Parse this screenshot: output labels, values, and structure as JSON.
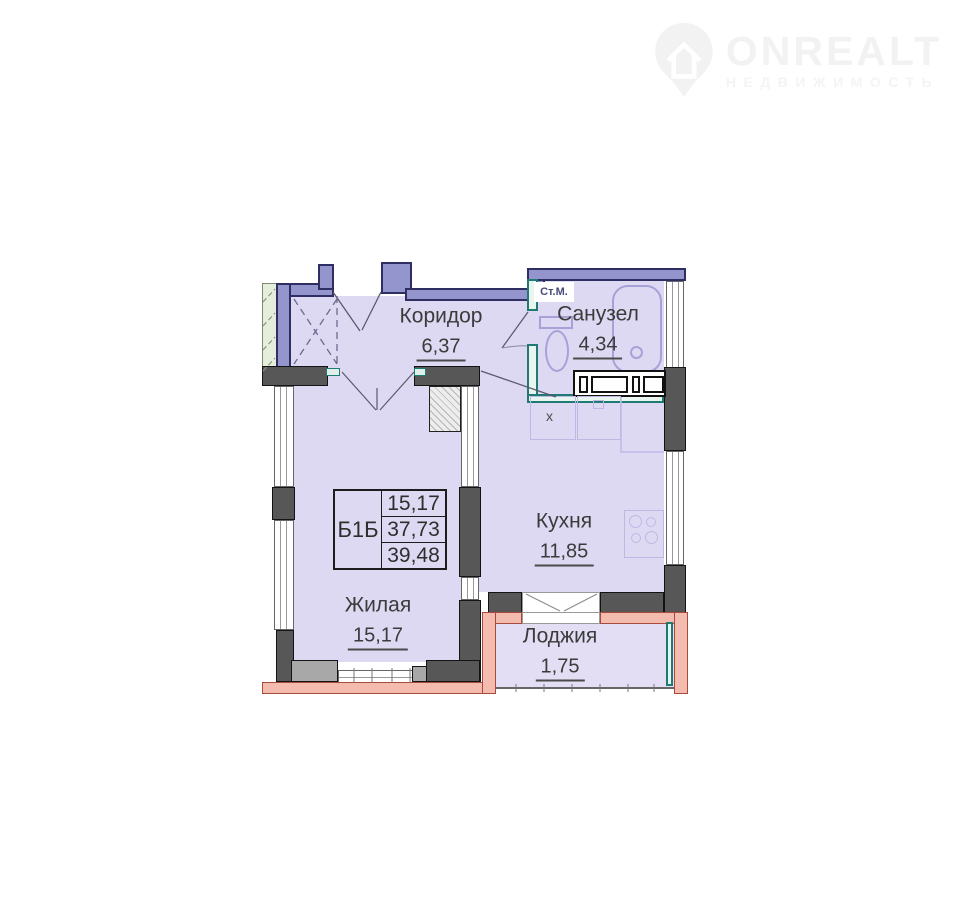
{
  "watermark": {
    "brand": "ONREALT",
    "subtitle": "НЕДВИЖИМОСТЬ",
    "icon": "location-pin-house-icon"
  },
  "plan": {
    "rooms": [
      {
        "name": "Коридор",
        "area": "6,37"
      },
      {
        "name": "Санузел",
        "area": "4,34"
      },
      {
        "name": "Кухня",
        "area": "11,85"
      },
      {
        "name": "Жилая",
        "area": "15,17"
      },
      {
        "name": "Лоджия",
        "area": "1,75"
      }
    ],
    "unit_table": {
      "unit": "Б1Б",
      "rows": [
        "15,17",
        "37,73",
        "39,48"
      ]
    },
    "annotations": {
      "washing_machine": "Ст.М.",
      "kitchen_marker": "х"
    },
    "colors": {
      "interior_wall": "#9595ce",
      "wall_outline": "#2e2e63",
      "partition_teal": "#1f7a74",
      "concrete_pier": "#575757",
      "loggia_wall": "#f4bcae",
      "floor": "#ded9f2",
      "adjacent_area": "#e4eeda",
      "text": "#3b3b3b",
      "watermark": "#f2f2f2"
    }
  }
}
